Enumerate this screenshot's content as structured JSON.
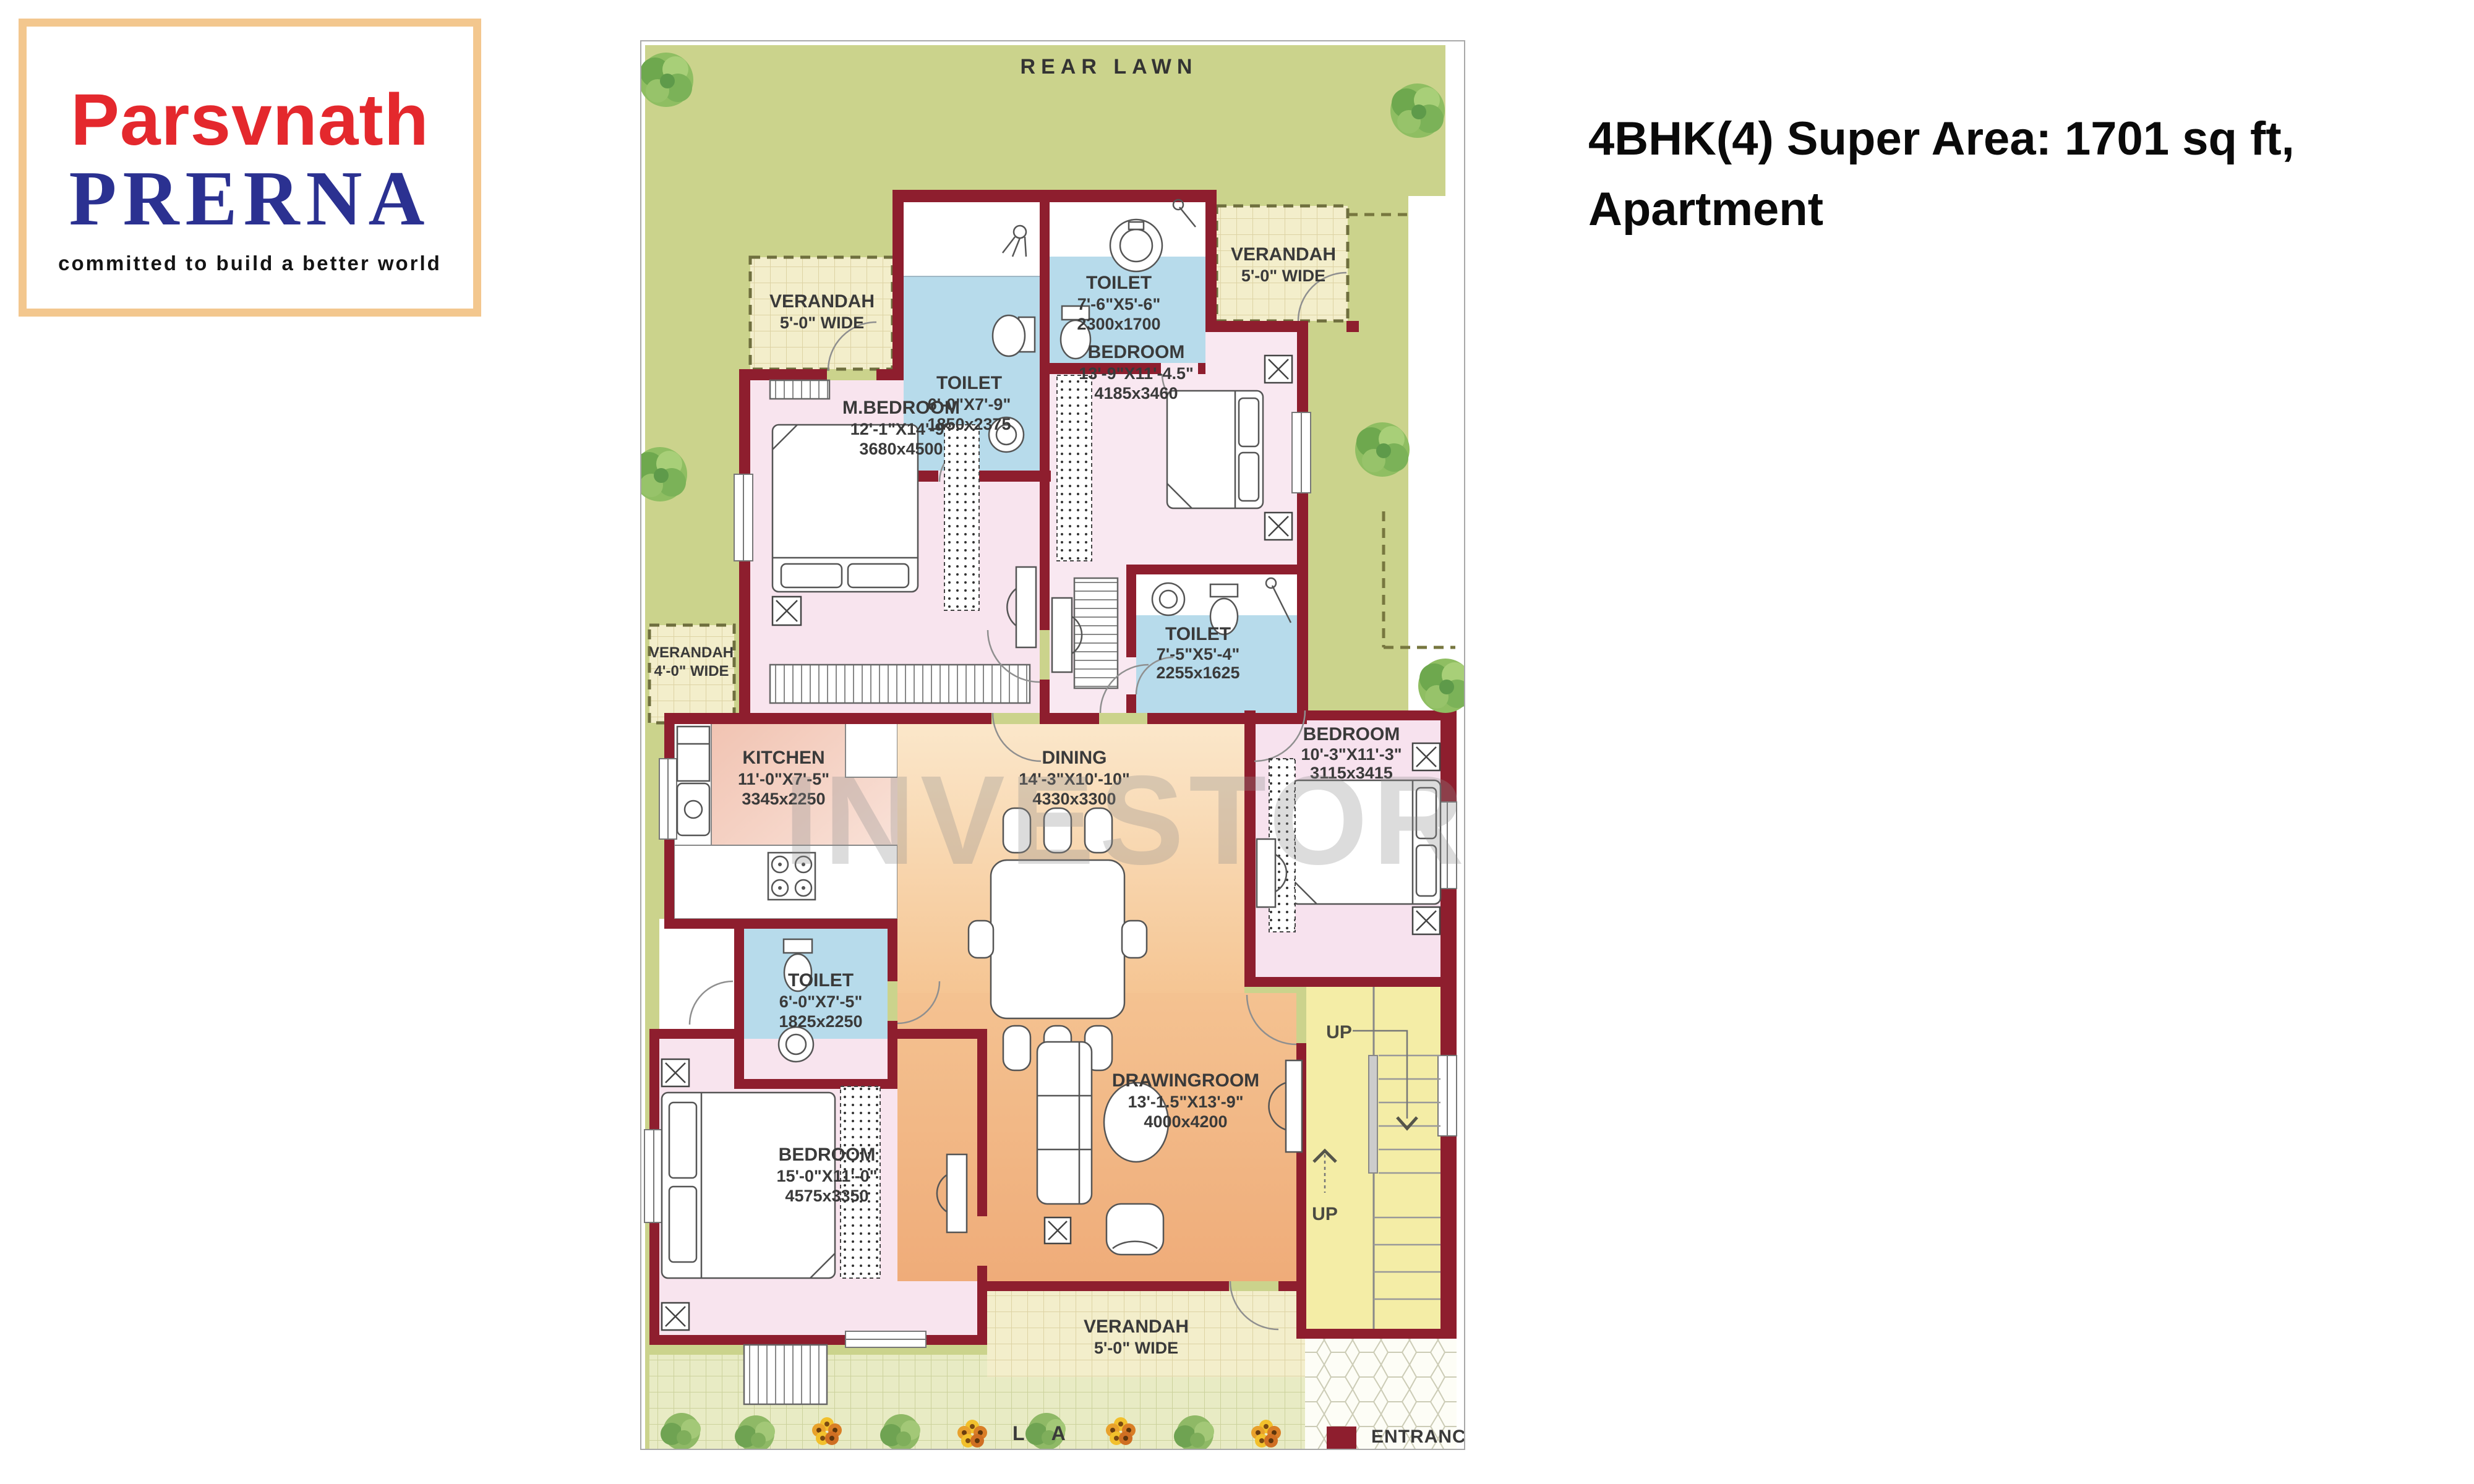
{
  "logo": {
    "brand": "Parsvnath",
    "project": "PRERNA",
    "tagline": "committed to build a better world"
  },
  "title": {
    "line1": "4BHK(4) Super Area: 1701 sq ft,",
    "line2": "Apartment"
  },
  "watermark": "INVESTOR MART",
  "plan": {
    "rear_lawn_label": "REAR LAWN",
    "lawn_label": "L A",
    "entrance_label": "ENTRANCE",
    "up_label_1": "UP",
    "up_label_2": "UP",
    "rooms": [
      {
        "name": "VERANDAH",
        "dims": "5'-0\" WIDE",
        "metric": ""
      },
      {
        "name": "TOILET",
        "dims": "6'-0\"X7'-9\"",
        "metric": "1850x2375"
      },
      {
        "name": "TOILET",
        "dims": "7'-6\"X5'-6\"",
        "metric": "2300x1700"
      },
      {
        "name": "VERANDAH",
        "dims": "5'-0\" WIDE",
        "metric": ""
      },
      {
        "name": "M.BEDROOM",
        "dims": "12'-1\"X14'-9\"",
        "metric": "3680x4500"
      },
      {
        "name": "BEDROOM",
        "dims": "13'-9\"X11'-4.5\"",
        "metric": "4185x3460"
      },
      {
        "name": "VERANDAH",
        "dims": "4'-0\" WIDE",
        "metric": ""
      },
      {
        "name": "TOILET",
        "dims": "7'-5\"X5'-4\"",
        "metric": "2255x1625"
      },
      {
        "name": "KITCHEN",
        "dims": "11'-0\"X7'-5\"",
        "metric": "3345x2250"
      },
      {
        "name": "DINING",
        "dims": "14'-3\"X10'-10\"",
        "metric": "4330x3300"
      },
      {
        "name": "BEDROOM",
        "dims": "10'-3\"X11'-3\"",
        "metric": "3115x3415"
      },
      {
        "name": "TOILET",
        "dims": "6'-0\"X7'-5\"",
        "metric": "1825x2250"
      },
      {
        "name": "BEDROOM",
        "dims": "15'-0\"X11'-0\"",
        "metric": "4575x3350"
      },
      {
        "name": "DRAWINGROOM",
        "dims": "13'-1.5\"X13'-9\"",
        "metric": "4000x4200"
      },
      {
        "name": "VERANDAH",
        "dims": "5'-0\" WIDE",
        "metric": ""
      }
    ]
  },
  "colors": {
    "wall": "#8e1e2e",
    "lawn": "#cbd38c",
    "verandah_tile": "#f3eecb",
    "toilet_blue": "#b7dbeb",
    "bedroom_pink": "#f8e4ee",
    "kitchen_salmon": "#f2c5b5",
    "dining_orange": "#f8ddb7",
    "drawing_orange": "#f0b584",
    "stairs_yellow": "#f4eda6",
    "logo_red": "#e4282d",
    "logo_blue": "#2b3191",
    "logo_frame_tan": "#f3c78e"
  }
}
